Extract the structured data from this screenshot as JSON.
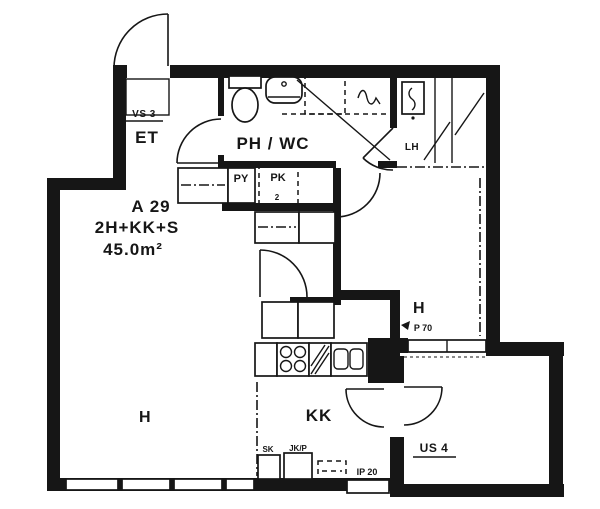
{
  "unit": {
    "id": "A 29",
    "composition": "2H+KK+S",
    "area": "45.0m²"
  },
  "rooms": {
    "entry": "ET",
    "bath": "PH / WC",
    "sauna": "LH",
    "room_left": "H",
    "room_right": "H",
    "kitchenette": "KK"
  },
  "codes": {
    "partition_wall": "VS 3",
    "exterior_wall": "US 4",
    "door": "P 70",
    "window": "IP 20"
  },
  "appliances": {
    "washer": "PY",
    "dryer": "PK",
    "dryer_note": "2",
    "cleaning_cabinet": "SK",
    "fridge": "JK/P"
  },
  "colors": {
    "ink": "#161616",
    "paper": "#ffffff"
  }
}
